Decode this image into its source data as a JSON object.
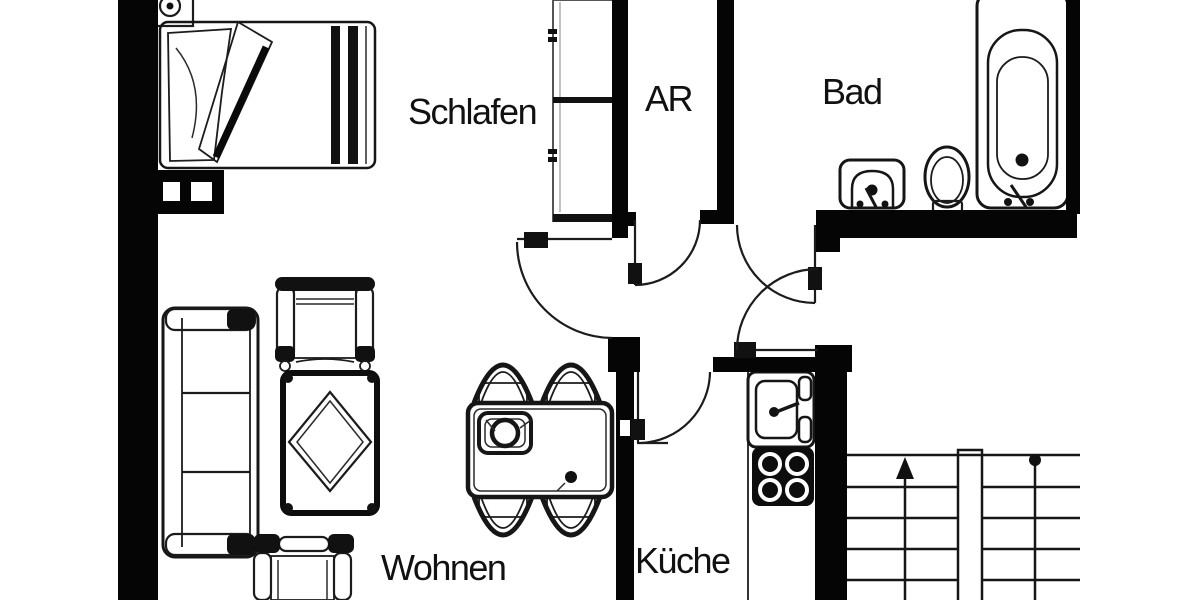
{
  "title": "Apartment floor plan",
  "rooms": {
    "bedroom": {
      "label": "Schlafen"
    },
    "storage": {
      "label": "AR"
    },
    "bathroom": {
      "label": "Bad"
    },
    "living": {
      "label": "Wohnen"
    },
    "kitchen": {
      "label": "Küche"
    }
  },
  "colors": {
    "wall": "#050505",
    "line": "#161616",
    "background": "#ffffff",
    "text": "#111111"
  },
  "fixtures": [
    "bed",
    "pillow",
    "blanket",
    "nightstand",
    "wardrobe",
    "chimney",
    "sofa",
    "armchair-top",
    "armchair-bottom",
    "couch-table",
    "dining-table",
    "dining-chair",
    "kitchen-sink",
    "stove",
    "bathroom-sink",
    "toilet",
    "bathtub",
    "door-bedroom",
    "door-storage",
    "door-bathroom",
    "door-entrance",
    "door-kitchen",
    "staircase",
    "stair-direction-arrow"
  ]
}
